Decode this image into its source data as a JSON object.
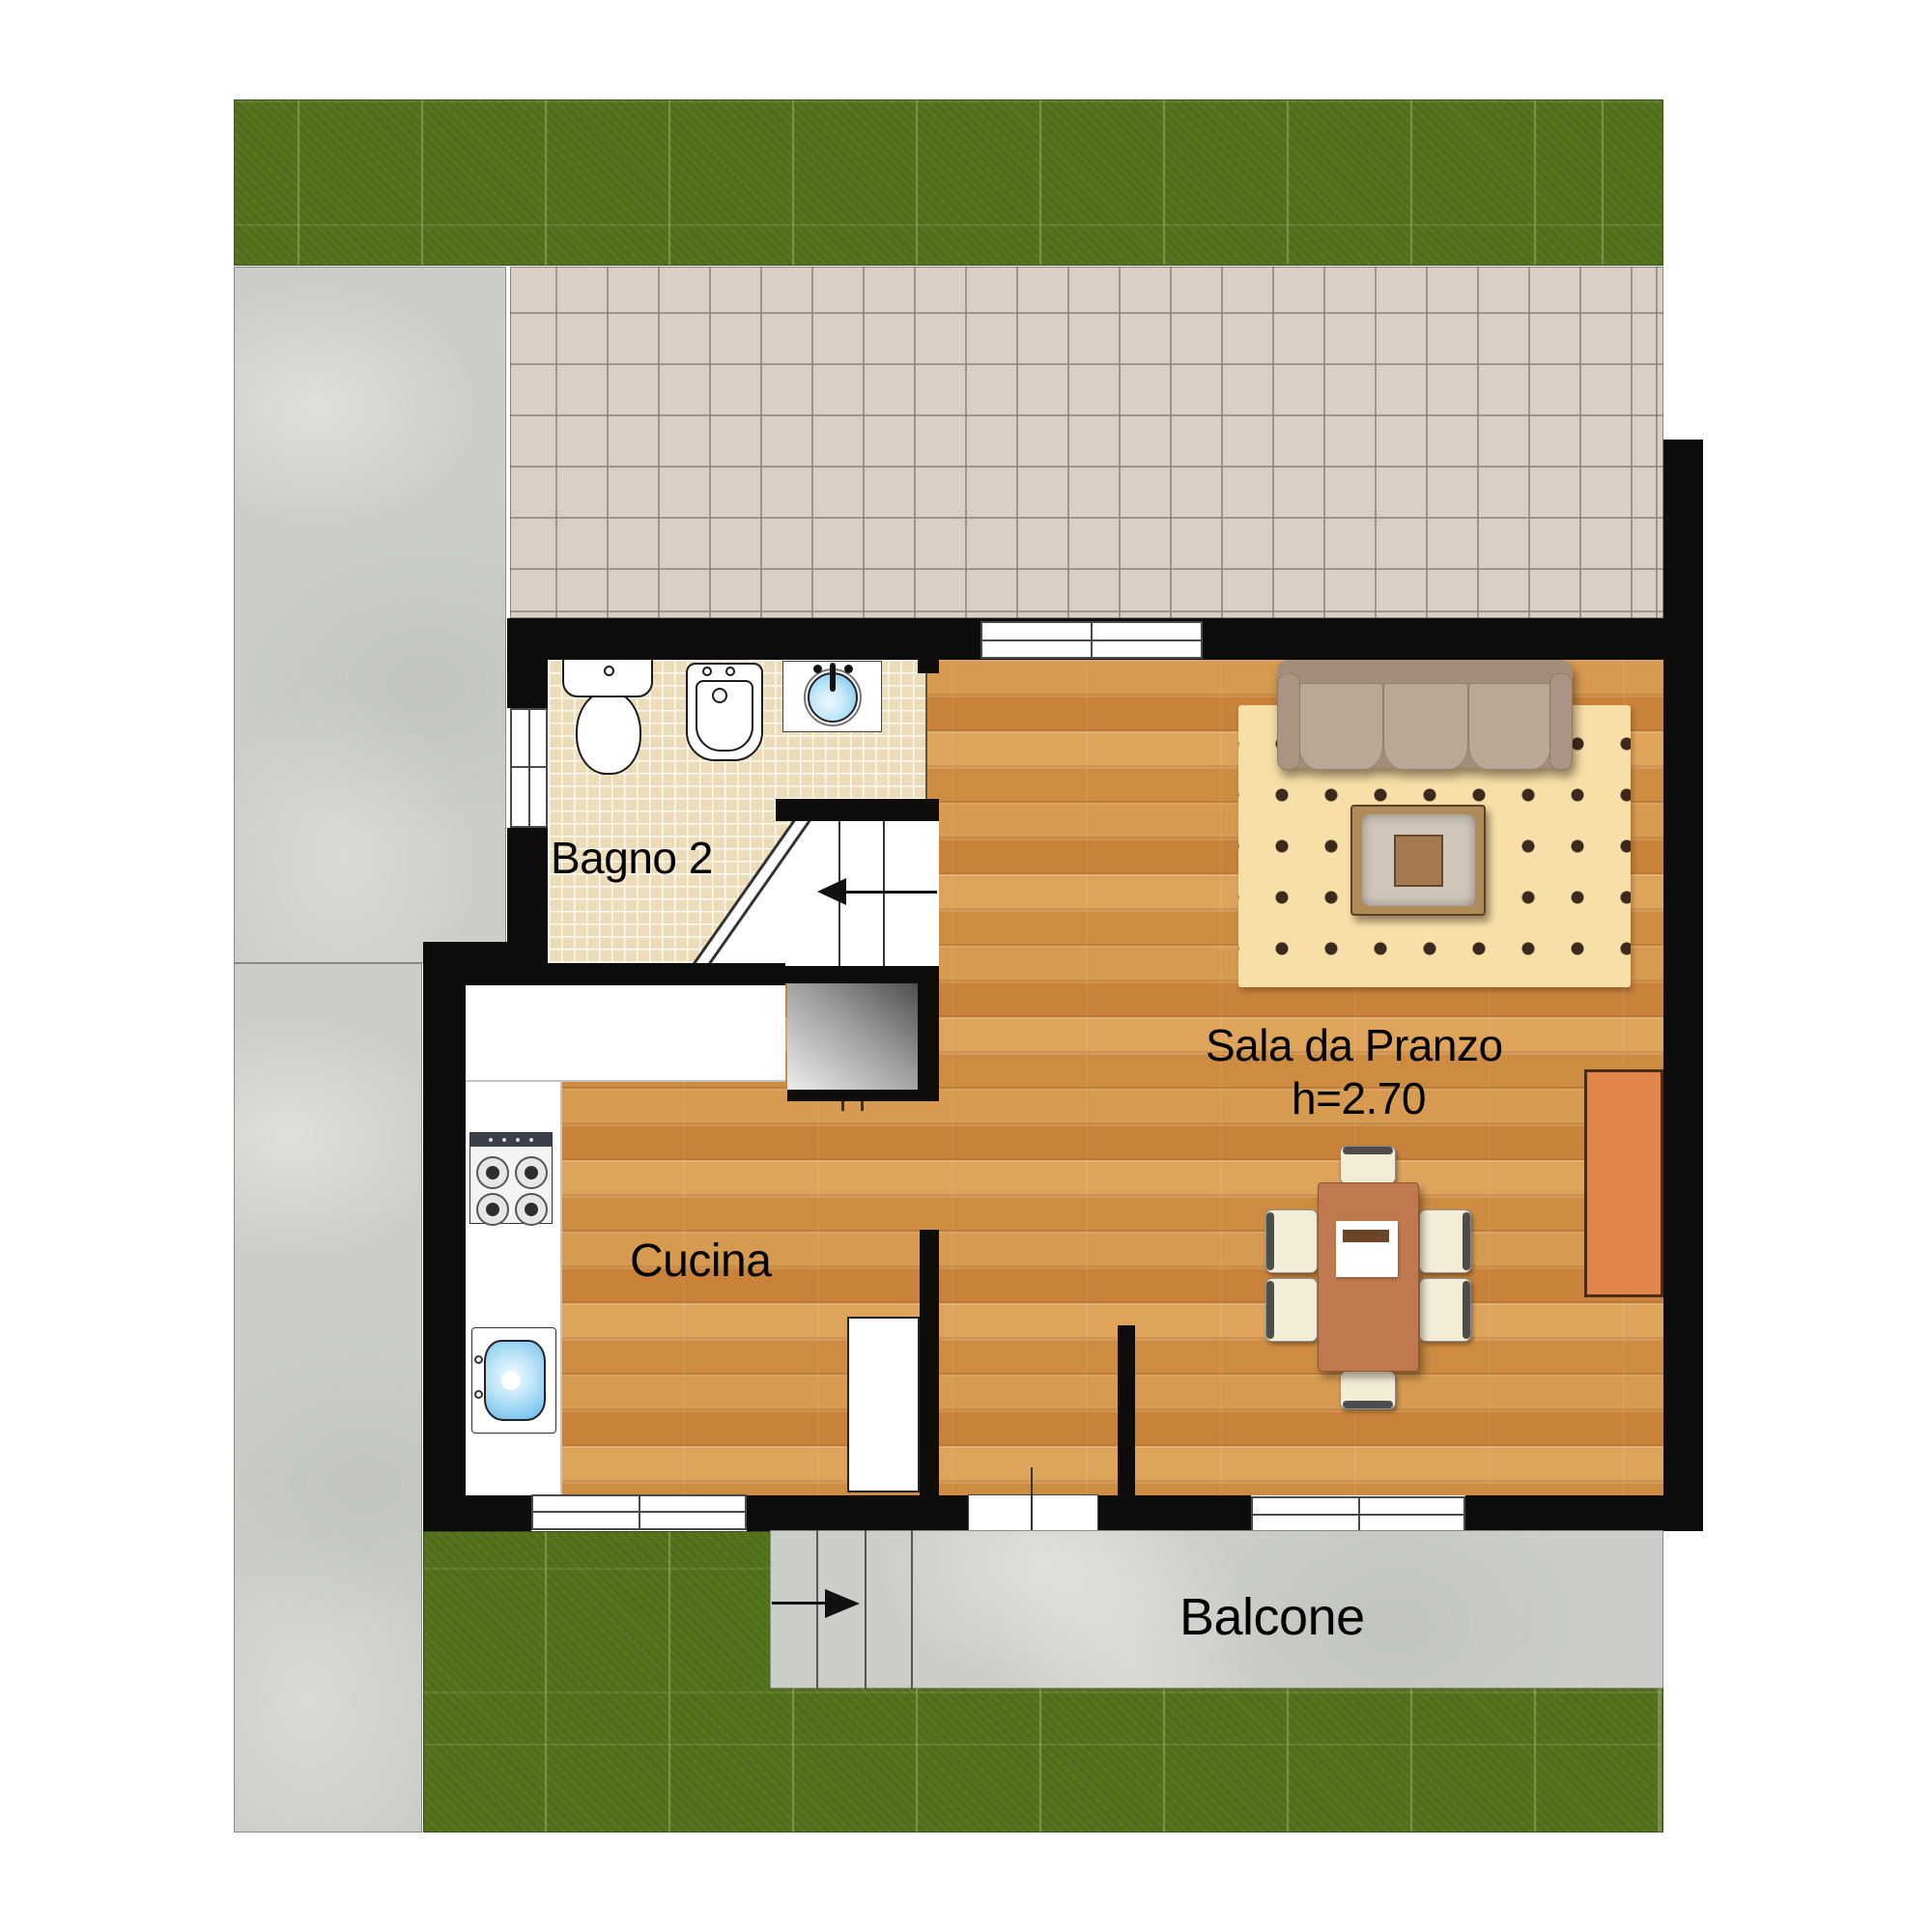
{
  "plan": {
    "type": "floor-plan",
    "floor_labels": {
      "bagno": "Bagno 2",
      "cucina": "Cucina",
      "sala": "Sala da Pranzo",
      "sala_height": "h=2.70",
      "balcone": "Balcone"
    },
    "rooms": [
      {
        "id": "bagno-2",
        "label": "Bagno 2"
      },
      {
        "id": "cucina",
        "label": "Cucina"
      },
      {
        "id": "sala-da-pranzo",
        "label": "Sala da Pranzo",
        "height_note": "h=2.70"
      },
      {
        "id": "balcone",
        "label": "Balcone"
      }
    ],
    "colors": {
      "wall": "#0e0d0b",
      "wood": "#cf8f42",
      "grass": "#55751e",
      "concrete": "#cbcec8",
      "terrace_tile": "#d9cfc5",
      "mosaic": "#ecdcb8",
      "rug": "#f8dfa8",
      "sofa": "#a58d7c",
      "cushion": "#bba795",
      "furniture_orange": "#e1854c",
      "table_orange": "#c0784f",
      "water_blue": "#63b9ec",
      "chair_cream": "#f3ecd7"
    }
  }
}
